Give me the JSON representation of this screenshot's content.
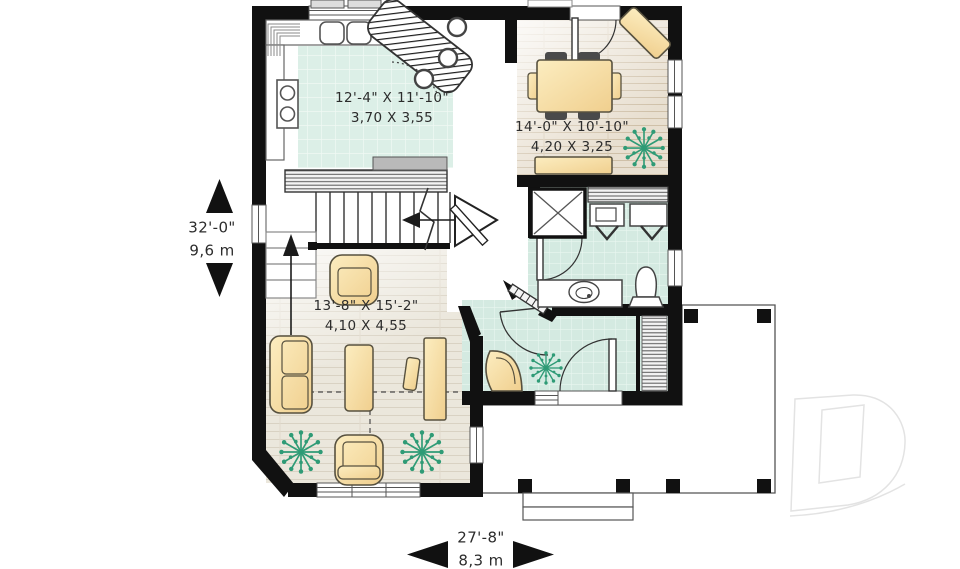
{
  "rooms": {
    "kitchen": {
      "imperial": "12'-4\" X 11'-10\"",
      "metric": "3,70 X 3,55"
    },
    "dining_room": {
      "imperial": "14'-0\" X 10'-10\"",
      "metric": "4,20 X 3,25"
    },
    "living_room": {
      "imperial": "13'-8\" X 15'-2\"",
      "metric": "4,10 X 4,55"
    }
  },
  "overall_dimensions": {
    "depth": {
      "imperial": "32'-0\"",
      "metric": "9,6 m"
    },
    "width": {
      "imperial": "27'-8\"",
      "metric": "8,3 m"
    }
  },
  "colors": {
    "wall": "#111111",
    "furniture": "#f2cf8e",
    "furniture_light": "#fcedc0",
    "plant": "#2f9b76",
    "kitchen_tile": "#dcefe7",
    "entry_tile": "#d4eae1",
    "dining_wood": "#e8dfd0",
    "living_wood": "#ebe7dc",
    "logo": "#e3e3e3",
    "text": "#2c2c2c"
  },
  "icons": {
    "plant": "plant-icon",
    "stair_up_arrow": "stair-up-arrow-icon",
    "stair_run_arrow": "stair-run-arrow-icon",
    "dim_arrow_up": "arrow-up-icon",
    "dim_arrow_down": "arrow-down-icon",
    "dim_arrow_left": "arrow-left-icon",
    "dim_arrow_right": "arrow-right-icon",
    "logo": "drummond-d-logo"
  }
}
